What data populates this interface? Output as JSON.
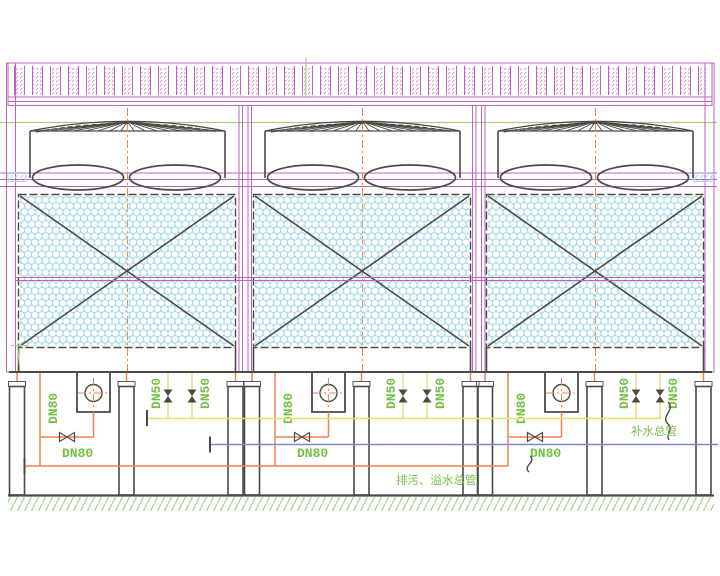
{
  "drawing": {
    "tower_count": 3,
    "labels": {
      "dn80": "DN80",
      "dn50": "DN50",
      "makeup_water_main": "补水总管",
      "drain_overflow_main": "排污、溢水总管"
    }
  },
  "colors": {
    "magenta": "#bd63bd",
    "magenta-light": "#cf8fcf",
    "dark": "#4d4a45",
    "orange": "#f0824e",
    "green": "#76bf45",
    "green-line": "#a8d080",
    "yellow": "#e2e272",
    "blue": "#8585cf",
    "cyan-hatch": "#a5dbe7",
    "cyan-cap": "#45c3de",
    "ground-green": "#a6d488"
  }
}
